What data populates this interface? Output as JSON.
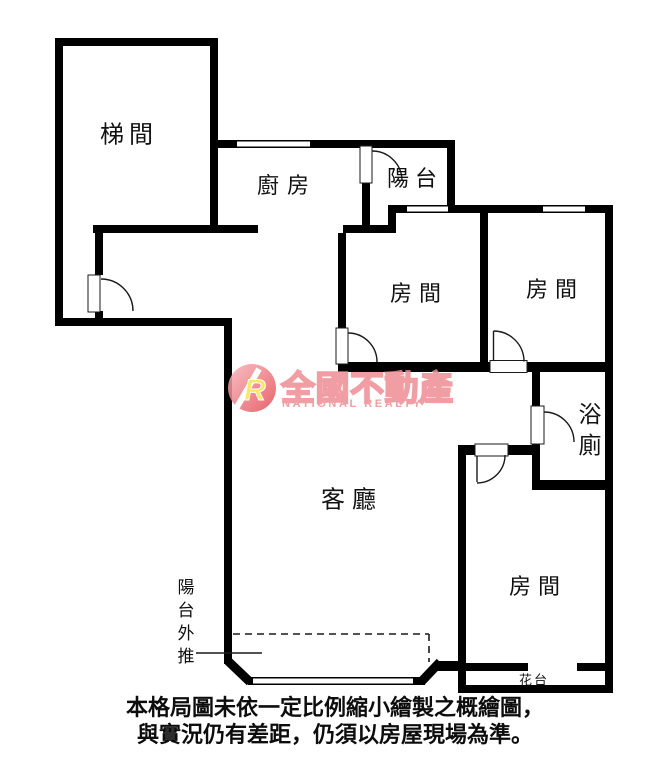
{
  "canvas": {
    "width": 671,
    "height": 770,
    "background": "#ffffff"
  },
  "colors": {
    "wall": "#000000",
    "door_line": "#1a1a1a",
    "watermark_pink": "#ee8d94",
    "logo_gradient_start": "#f7b6bd",
    "logo_gradient_end": "#e64852",
    "logo_letter_fill": "#ffe14d"
  },
  "rooms": {
    "stairwell": {
      "label": "梯間"
    },
    "kitchen": {
      "label": "廚房"
    },
    "balcony": {
      "label": "陽台"
    },
    "bedroom_mid": {
      "label": "房間"
    },
    "bedroom_top_right": {
      "label": "房間"
    },
    "bedroom_bottom": {
      "label": "房間"
    },
    "bathroom": {
      "label": "浴廁"
    },
    "living_room": {
      "label": "客廳"
    },
    "flower_stand": {
      "label": "花台"
    }
  },
  "annotations": {
    "balcony_pushed_out": "陽台外推"
  },
  "watermark": {
    "brand_zh": "全國不動產",
    "brand_en": "NATIONAL REALTY",
    "logo_letter": "R"
  },
  "disclaimer": {
    "line1": "本格局圖未依一定比例縮小繪製之概繪圖，",
    "line2": "與實況仍有差距，仍須以房屋現場為準。"
  }
}
